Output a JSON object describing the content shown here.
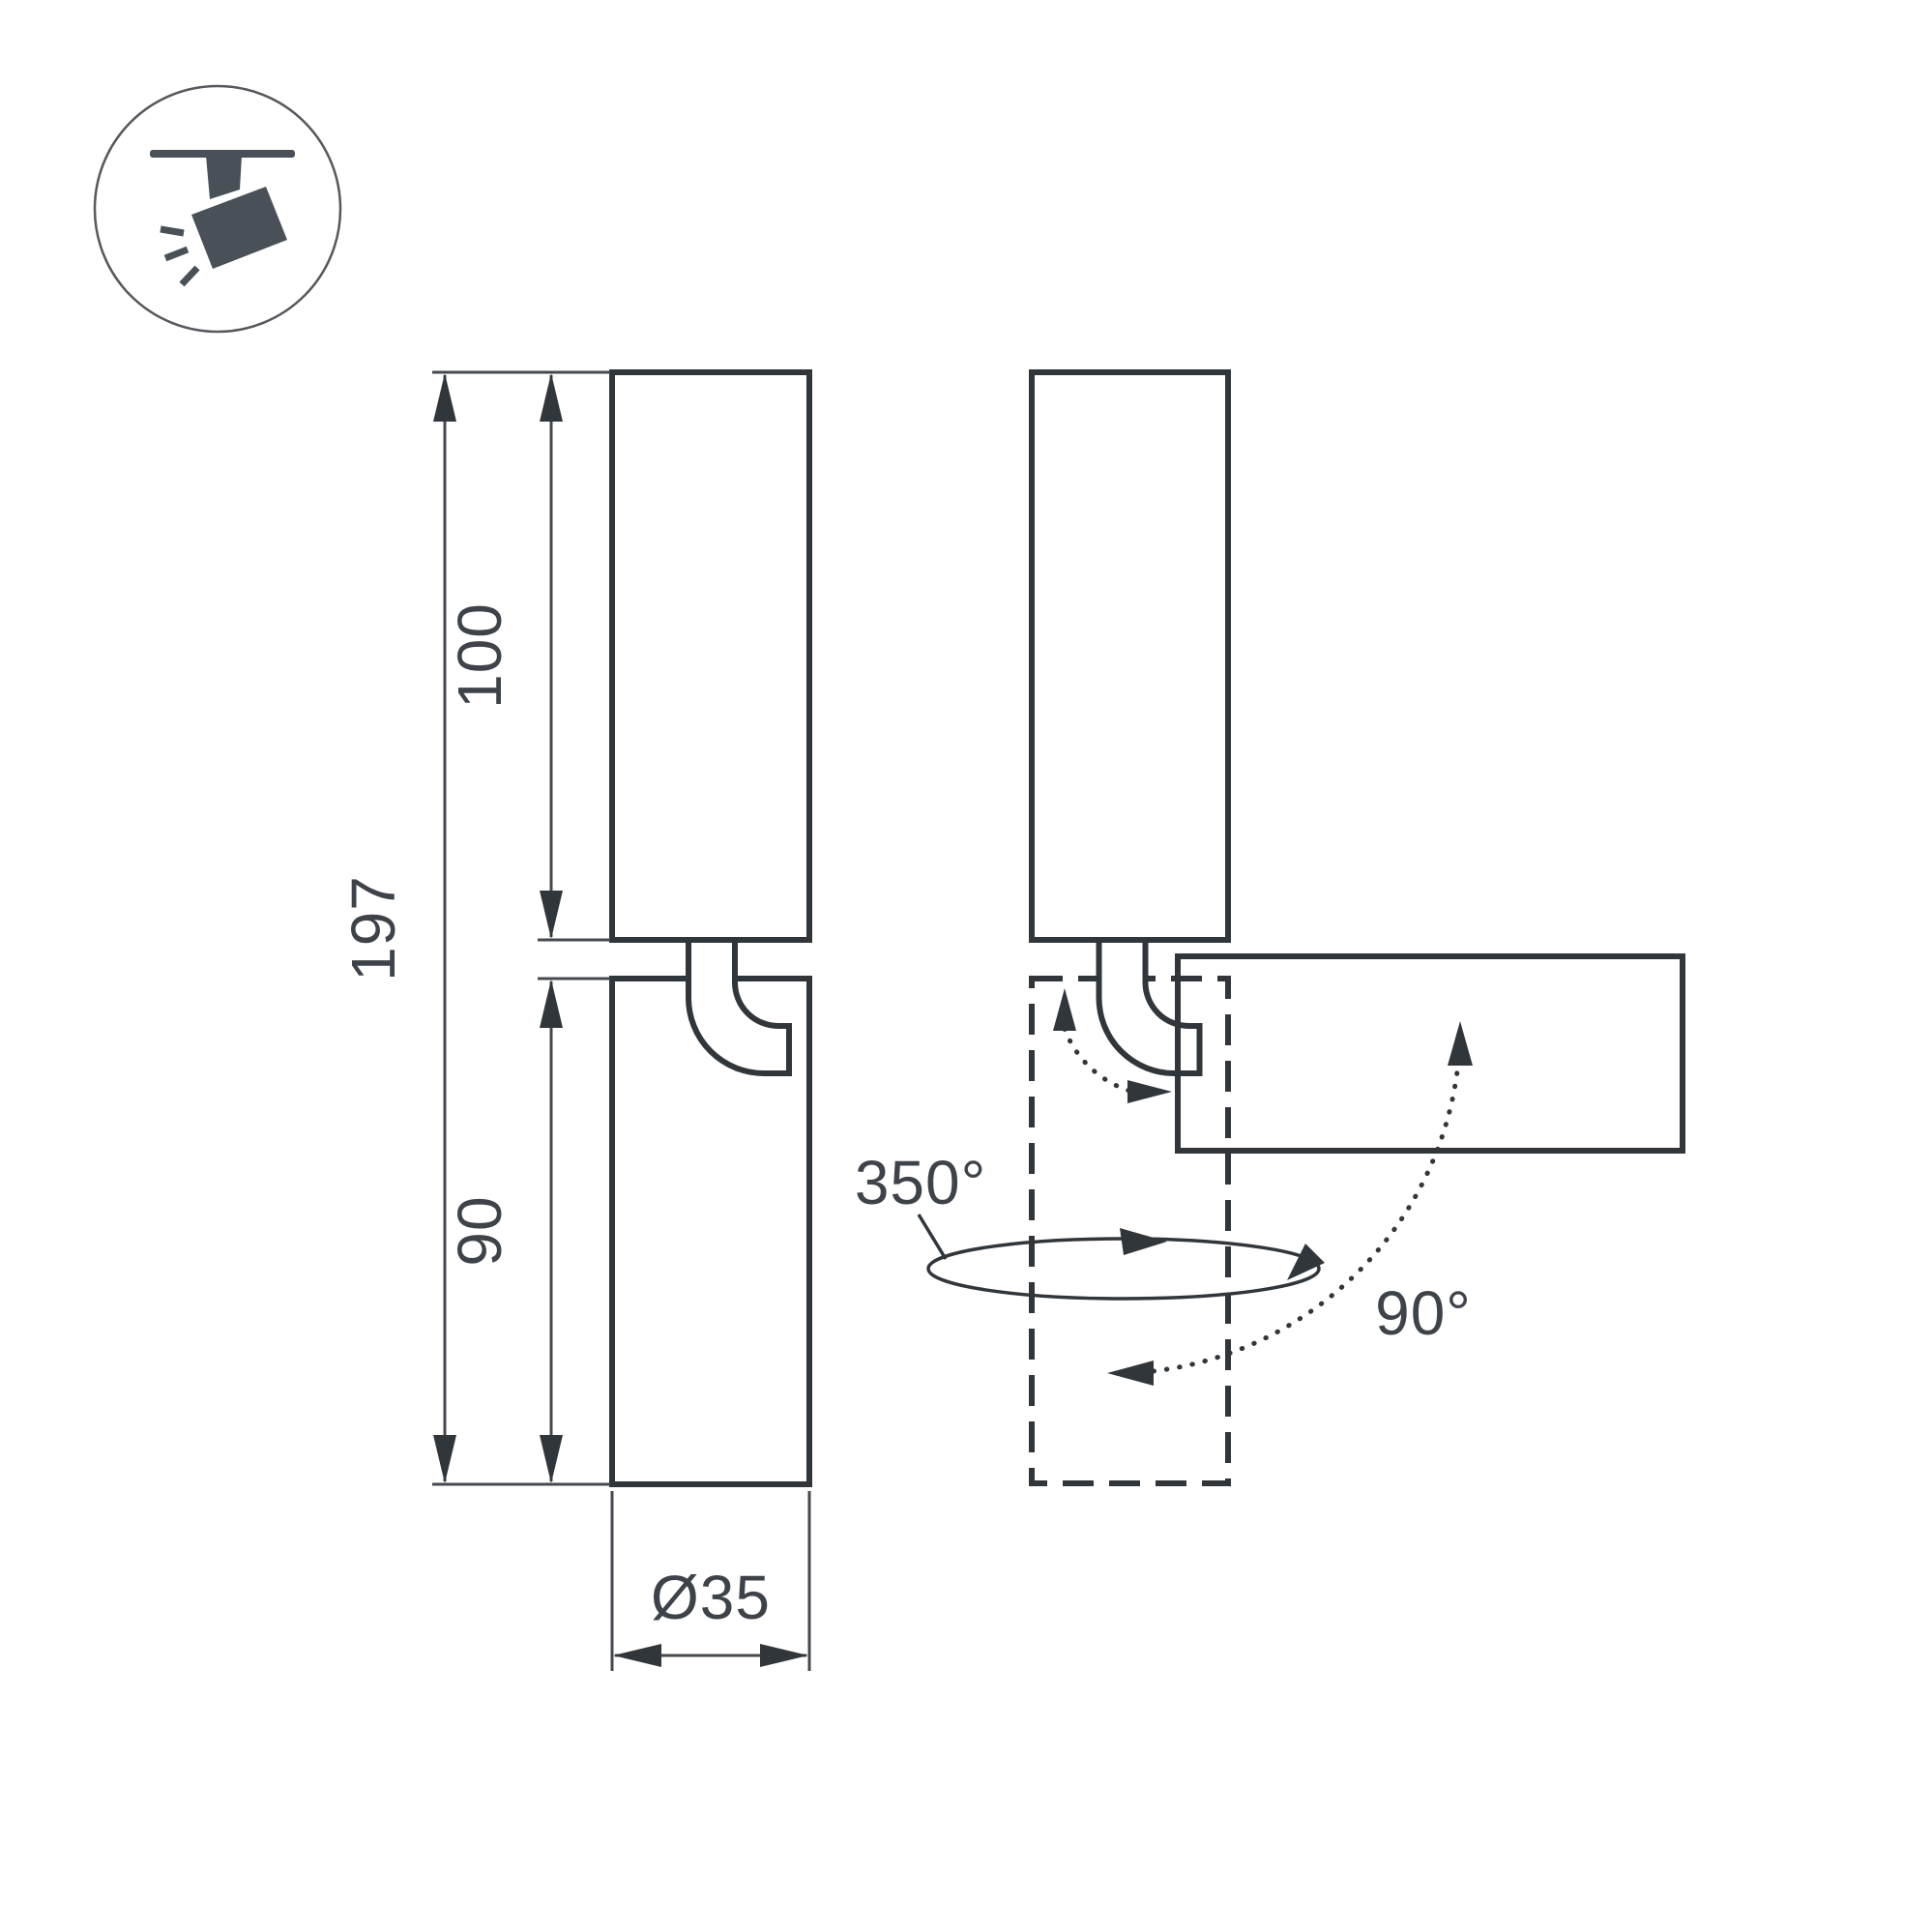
{
  "colors": {
    "background": "#ffffff",
    "outline": "#31363b",
    "dimension_line": "#45494f",
    "text": "#3e4349",
    "icon": "#4a5057",
    "icon_circle_border": "#55585d"
  },
  "icons": {
    "badge": "track-spotlight-icon"
  },
  "labels": {
    "overall_height": "197",
    "upper_height": "100",
    "lower_height": "90",
    "diameter": "Ø35",
    "pan_angle": "350°",
    "tilt_angle": "90°"
  }
}
